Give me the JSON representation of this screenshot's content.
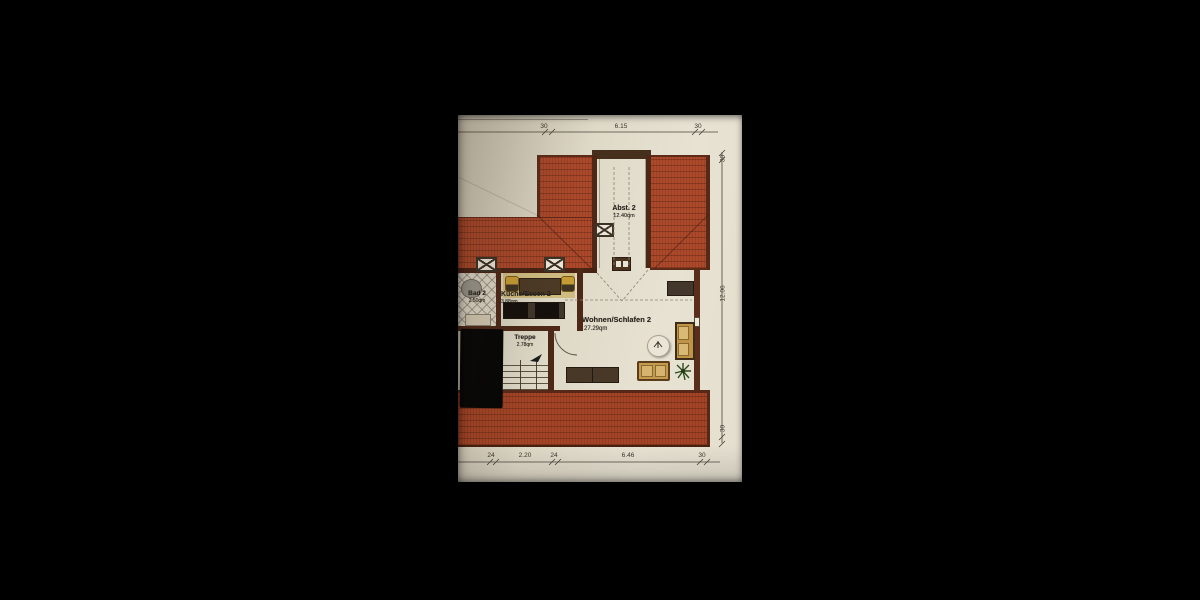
{
  "plan": {
    "title": "Dachgeschoss Wohnung 2 Grundriss",
    "rooms": [
      {
        "name": "Abst. 2",
        "area": "12.40qm"
      },
      {
        "name": "Bad 2",
        "area": "2.50qm"
      },
      {
        "name": "Küche/Essen 2",
        "area": "3.88qm"
      },
      {
        "name": "Treppe",
        "area": "2.78qm"
      },
      {
        "name": "Wohnen/Schlafen 2",
        "area": "27.29qm"
      }
    ],
    "dimensions": {
      "top": [
        "30",
        "6.15",
        "30"
      ],
      "right": [
        "30",
        "12.06",
        "30"
      ],
      "bottom": [
        "24",
        "2.20",
        "24",
        "6.46",
        "30"
      ]
    },
    "symbols": {
      "chimney_marker": "⊠",
      "window_marker": "▭",
      "stair_direction_arrow": "➤",
      "plant": "✳"
    },
    "colors": {
      "background": "#000000",
      "paper": "#e2dccb",
      "roof_red": "#ac492b",
      "wall_brown": "#4e2817",
      "furniture_tan": "#c49a4e",
      "furniture_dark": "#43362a",
      "plant_green": "#2f4c1e"
    }
  }
}
